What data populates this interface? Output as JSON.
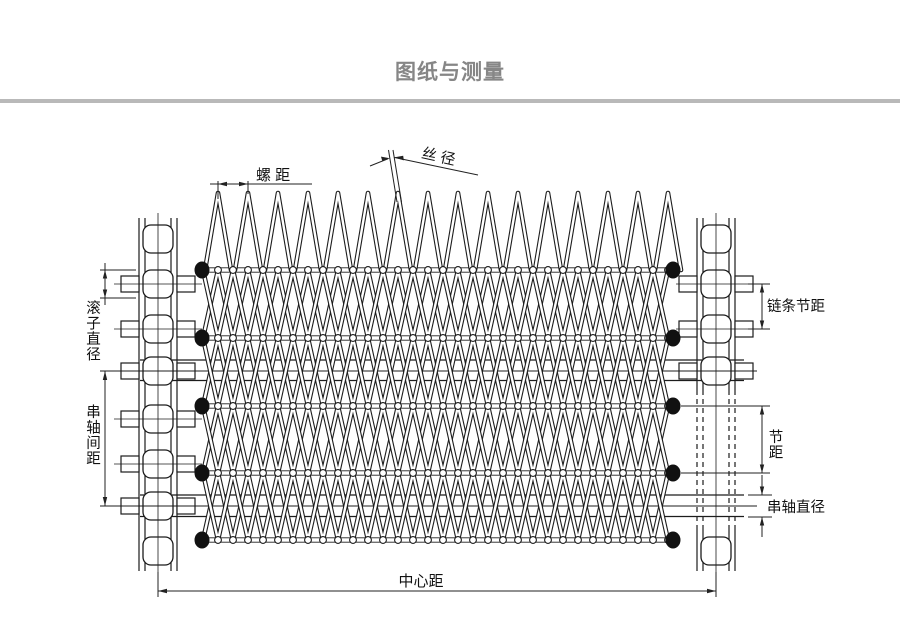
{
  "page": {
    "title": "图纸与测量",
    "background": "#ffffff"
  },
  "colors": {
    "ink": "#1c1c1c",
    "dim": "#222222",
    "wire_core": "#ffffff",
    "title_gray": "#868686",
    "divider_gray": "#b9b9b9",
    "dot_fill": "#111111"
  },
  "diagram": {
    "labels": {
      "spiral_pitch": "螺 距",
      "wire_diameter": "丝 径",
      "roller_diameter": "滚子直径",
      "rod_spacing": "串轴间距",
      "chain_pitch": "链条节距",
      "pitch": "节距",
      "rod_diameter": "串轴直径",
      "center_distance": "中心距"
    }
  }
}
